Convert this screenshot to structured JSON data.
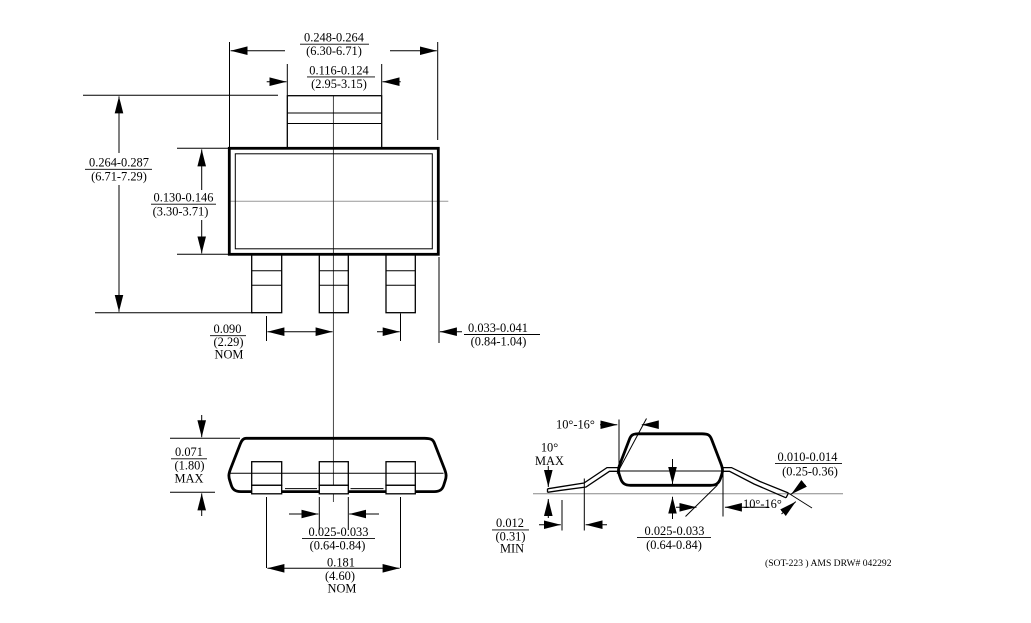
{
  "footer": {
    "note": "(SOT-223 ) AMS DRW# 042292"
  },
  "top_view": {
    "body_width": {
      "in": "0.248-0.264",
      "mm": "(6.30-6.71)"
    },
    "tab_width": {
      "in": "0.116-0.124",
      "mm": "(2.95-3.15)"
    },
    "overall_height": {
      "in": "0.264-0.287",
      "mm": "(6.71-7.29)"
    },
    "body_height": {
      "in": "0.130-0.146",
      "mm": "(3.30-3.71)"
    },
    "lead_pitch": {
      "in": "0.090",
      "mm": "(2.29)",
      "qual": "NOM"
    },
    "lead_width": {
      "in": "0.033-0.041",
      "mm": "(0.84-1.04)"
    }
  },
  "front_view": {
    "height": {
      "in": "0.071",
      "mm": "(1.80)",
      "qual": "MAX"
    },
    "center_lead_width": {
      "in": "0.025-0.033",
      "mm": "(0.64-0.84)"
    },
    "outer_lead_span": {
      "in": "0.181",
      "mm": "(4.60)",
      "qual": "NOM"
    }
  },
  "side_view": {
    "top_angle": "10°-16°",
    "side_angle": {
      "value": "10°",
      "qual": "MAX"
    },
    "standoff": {
      "in": "0.012",
      "mm": "(0.31)",
      "qual": "MIN"
    },
    "foot_width": {
      "in": "0.025-0.033",
      "mm": "(0.64-0.84)"
    },
    "lead_thickness": {
      "in": "0.010-0.014",
      "mm": "(0.25-0.36)"
    },
    "foot_angle": "10°-16°"
  }
}
